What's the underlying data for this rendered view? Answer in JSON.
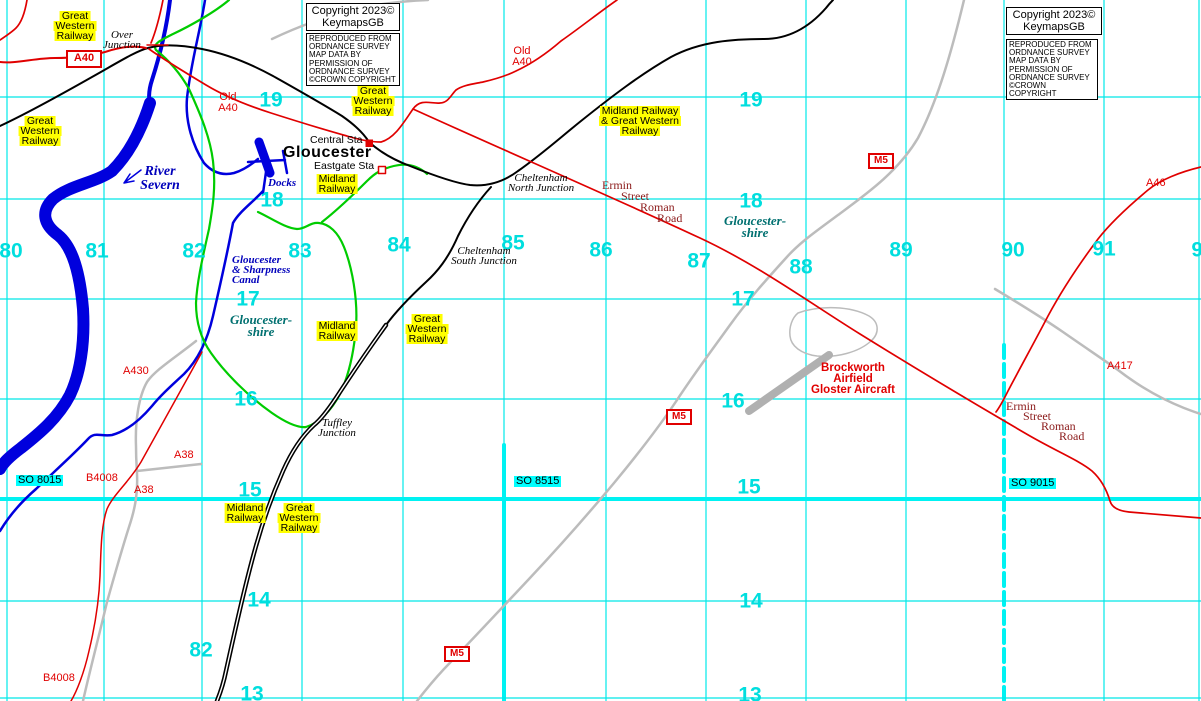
{
  "colors": {
    "grid": "#00e8e8",
    "gridbold": "#00f2f2",
    "num": "#00dede",
    "water": "#0000dd",
    "watertext": "#0000bb",
    "rail": "#000000",
    "roadred": "#e00000",
    "roadgray": "#bcbcbc",
    "runway": "#b0b0b0",
    "boundary": "#00cc00",
    "county": "#007070",
    "roman": "#8b1a1a",
    "highlight": "#ffff00",
    "sqbg": "#00ffff"
  },
  "grid": {
    "vlines": [
      {
        "x": 7
      },
      {
        "x": 104
      },
      {
        "x": 202
      },
      {
        "x": 302
      },
      {
        "x": 403
      },
      {
        "x": 504,
        "thickFrom": 445
      },
      {
        "x": 606
      },
      {
        "x": 706
      },
      {
        "x": 806
      },
      {
        "x": 906
      },
      {
        "x": 1004,
        "thickFrom": 345,
        "dash": true
      },
      {
        "x": 1104
      },
      {
        "x": 1199
      }
    ],
    "hlines": [
      {
        "y": 97
      },
      {
        "y": 199
      },
      {
        "y": 299
      },
      {
        "y": 399
      },
      {
        "y": 499,
        "thick": true
      },
      {
        "y": 601
      },
      {
        "y": 698
      }
    ],
    "numbers": [
      {
        "t": "80",
        "x": 11,
        "y": 251
      },
      {
        "t": "81",
        "x": 97,
        "y": 251
      },
      {
        "t": "82",
        "x": 194,
        "y": 251
      },
      {
        "t": "83",
        "x": 300,
        "y": 251
      },
      {
        "t": "84",
        "x": 399,
        "y": 245
      },
      {
        "t": "85",
        "x": 513,
        "y": 243
      },
      {
        "t": "86",
        "x": 601,
        "y": 250
      },
      {
        "t": "87",
        "x": 699,
        "y": 261
      },
      {
        "t": "88",
        "x": 801,
        "y": 267
      },
      {
        "t": "89",
        "x": 901,
        "y": 250
      },
      {
        "t": "90",
        "x": 1013,
        "y": 250
      },
      {
        "t": "91",
        "x": 1104,
        "y": 249
      },
      {
        "t": "92",
        "x": 1203,
        "y": 250
      },
      {
        "t": "82",
        "x": 201,
        "y": 650
      },
      {
        "t": "19",
        "x": 271,
        "y": 100
      },
      {
        "t": "19",
        "x": 751,
        "y": 100
      },
      {
        "t": "18",
        "x": 272,
        "y": 200
      },
      {
        "t": "18",
        "x": 751,
        "y": 201
      },
      {
        "t": "17",
        "x": 248,
        "y": 299
      },
      {
        "t": "17",
        "x": 743,
        "y": 299
      },
      {
        "t": "16",
        "x": 246,
        "y": 399
      },
      {
        "t": "16",
        "x": 733,
        "y": 401
      },
      {
        "t": "15",
        "x": 250,
        "y": 490
      },
      {
        "t": "15",
        "x": 749,
        "y": 487
      },
      {
        "t": "14",
        "x": 259,
        "y": 600
      },
      {
        "t": "14",
        "x": 751,
        "y": 601
      },
      {
        "t": "13",
        "x": 252,
        "y": 694
      },
      {
        "t": "13",
        "x": 750,
        "y": 695
      }
    ]
  },
  "boxes": [
    {
      "name": "copyright-box-left",
      "cls": "cpr",
      "x": 306,
      "y": 3,
      "w": 88,
      "lines": [
        "Copyright 2023©",
        "KeymapsGB"
      ]
    },
    {
      "name": "os-credit-box-left",
      "cls": "os",
      "x": 306,
      "y": 33,
      "w": 88,
      "lines": [
        "REPRODUCED FROM",
        "ORDNANCE SURVEY",
        "MAP DATA BY",
        "PERMISSION OF",
        "ORDNANCE SURVEY",
        "©CROWN COPYRIGHT"
      ]
    },
    {
      "name": "copyright-box-right",
      "cls": "cpr",
      "x": 1006,
      "y": 7,
      "w": 90,
      "lines": [
        "Copyright 2023©",
        "KeymapsGB"
      ]
    },
    {
      "name": "os-credit-box-right",
      "cls": "os",
      "x": 1006,
      "y": 39,
      "w": 86,
      "lines": [
        "REPRODUCED FROM",
        "ORDNANCE SURVEY",
        "MAP DATA BY",
        "PERMISSION OF",
        "ORDNANCE SURVEY",
        "©CROWN COPYRIGHT"
      ]
    }
  ],
  "shields": [
    {
      "t": "A40",
      "x": 66,
      "y": 50,
      "w": 32,
      "h": 14,
      "big": true
    },
    {
      "t": "M5",
      "x": 868,
      "y": 153,
      "w": 22,
      "h": 12
    },
    {
      "t": "M5",
      "x": 666,
      "y": 409,
      "w": 22,
      "h": 12
    },
    {
      "t": "M5",
      "x": 444,
      "y": 646,
      "w": 22,
      "h": 12
    }
  ],
  "labels": [
    {
      "name": "label-gwr-topleft",
      "cls": "rail",
      "x": 75,
      "y": 11,
      "align": "c",
      "lines": [
        "Great",
        "Western",
        "Railway"
      ]
    },
    {
      "name": "label-gwr-left",
      "cls": "rail",
      "x": 40,
      "y": 116,
      "align": "c",
      "lines": [
        "Great",
        "Western",
        "Railway"
      ]
    },
    {
      "name": "label-gwr-topcenter",
      "cls": "rail",
      "x": 373,
      "y": 86,
      "align": "c",
      "lines": [
        "Great",
        "Western",
        "Railway"
      ]
    },
    {
      "name": "label-midland-eastgate",
      "cls": "rail",
      "x": 337,
      "y": 174,
      "align": "c",
      "lines": [
        "Midland",
        "Railway"
      ]
    },
    {
      "name": "label-midland-center",
      "cls": "rail",
      "x": 337,
      "y": 321,
      "align": "c",
      "lines": [
        "Midland",
        "Railway"
      ]
    },
    {
      "name": "label-gwr-center",
      "cls": "rail",
      "x": 427,
      "y": 314,
      "align": "c",
      "lines": [
        "Great",
        "Western",
        "Railway"
      ]
    },
    {
      "name": "label-midland-bottom",
      "cls": "rail",
      "x": 245,
      "y": 503,
      "align": "c",
      "lines": [
        "Midland",
        "Railway"
      ]
    },
    {
      "name": "label-gwr-bottom",
      "cls": "rail",
      "x": 299,
      "y": 503,
      "align": "c",
      "lines": [
        "Great",
        "Western",
        "Railway"
      ]
    },
    {
      "name": "label-midland-and-gwr",
      "cls": "rail",
      "x": 640,
      "y": 106,
      "align": "c",
      "lines": [
        "Midland Railway",
        "& Great Western",
        "Railway"
      ]
    },
    {
      "name": "label-old-a40-west",
      "cls": "road",
      "x": 228,
      "y": 92,
      "align": "c",
      "lines": [
        "Old",
        "A40"
      ]
    },
    {
      "name": "label-old-a40-east",
      "cls": "road",
      "x": 522,
      "y": 46,
      "align": "c",
      "lines": [
        "Old",
        "A40"
      ]
    },
    {
      "name": "label-a46",
      "cls": "road",
      "x": 1146,
      "y": 178,
      "lines": [
        "A46"
      ]
    },
    {
      "name": "label-a417",
      "cls": "road",
      "x": 1107,
      "y": 361,
      "lines": [
        "A417"
      ]
    },
    {
      "name": "label-a430",
      "cls": "road",
      "x": 123,
      "y": 366,
      "lines": [
        "A430"
      ]
    },
    {
      "name": "label-a38-upper",
      "cls": "road",
      "x": 174,
      "y": 450,
      "lines": [
        "A38"
      ]
    },
    {
      "name": "label-a38-lower",
      "cls": "road",
      "x": 134,
      "y": 485,
      "lines": [
        "A38"
      ]
    },
    {
      "name": "label-b4008-upper",
      "cls": "road",
      "x": 86,
      "y": 473,
      "lines": [
        "B4008"
      ]
    },
    {
      "name": "label-b4008-lower",
      "cls": "road",
      "x": 43,
      "y": 673,
      "lines": [
        "B4008"
      ]
    },
    {
      "name": "label-ermin-1a",
      "cls": "roman",
      "x": 602,
      "y": 180,
      "lines": [
        "Ermin"
      ]
    },
    {
      "name": "label-ermin-1b",
      "cls": "roman",
      "x": 621,
      "y": 191,
      "lines": [
        "Street"
      ]
    },
    {
      "name": "label-ermin-1c",
      "cls": "roman",
      "x": 640,
      "y": 202,
      "lines": [
        "Roman"
      ]
    },
    {
      "name": "label-ermin-1d",
      "cls": "roman",
      "x": 657,
      "y": 213,
      "lines": [
        "Road"
      ]
    },
    {
      "name": "label-ermin-2a",
      "cls": "roman",
      "x": 1006,
      "y": 401,
      "lines": [
        "Ermin"
      ]
    },
    {
      "name": "label-ermin-2b",
      "cls": "roman",
      "x": 1023,
      "y": 411,
      "lines": [
        "Street"
      ]
    },
    {
      "name": "label-ermin-2c",
      "cls": "roman",
      "x": 1041,
      "y": 421,
      "lines": [
        "Roman"
      ]
    },
    {
      "name": "label-ermin-2d",
      "cls": "roman",
      "x": 1059,
      "y": 431,
      "lines": [
        "Road"
      ]
    },
    {
      "name": "label-over-junction",
      "cls": "jct",
      "x": 122,
      "y": 30,
      "align": "c",
      "lines": [
        "Over",
        "Junction"
      ]
    },
    {
      "name": "label-cheltenham-north-junction",
      "cls": "jct",
      "x": 541,
      "y": 173,
      "align": "c",
      "lines": [
        "Cheltenham",
        "North Junction"
      ]
    },
    {
      "name": "label-cheltenham-south-junction",
      "cls": "jct",
      "x": 484,
      "y": 246,
      "align": "c",
      "lines": [
        "Cheltenham",
        "South Junction"
      ]
    },
    {
      "name": "label-tuffley-junction",
      "cls": "jct",
      "x": 337,
      "y": 418,
      "align": "c",
      "lines": [
        "Tuffley",
        "Junction"
      ]
    },
    {
      "name": "label-central-station",
      "cls": "sta",
      "x": 310,
      "y": 135,
      "lines": [
        "Central Sta"
      ]
    },
    {
      "name": "label-eastgate-station",
      "cls": "sta",
      "x": 314,
      "y": 161,
      "lines": [
        "Eastgate Sta"
      ]
    },
    {
      "name": "label-gloucester-city",
      "cls": "city",
      "x": 283,
      "y": 145,
      "lines": [
        "Gloucester"
      ]
    },
    {
      "name": "label-river-severn",
      "cls": "water lg",
      "x": 160,
      "y": 165,
      "align": "c",
      "lines": [
        "River",
        "Severn"
      ]
    },
    {
      "name": "label-docks",
      "cls": "water",
      "x": 268,
      "y": 178,
      "lines": [
        "Docks"
      ]
    },
    {
      "name": "label-canal",
      "cls": "water",
      "x": 232,
      "y": 255,
      "lines": [
        "Gloucester",
        "& Sharpness",
        "Canal"
      ]
    },
    {
      "name": "label-gloucestershire-west",
      "cls": "county",
      "x": 261,
      "y": 314,
      "align": "c",
      "lines": [
        "Gloucester-",
        "shire"
      ]
    },
    {
      "name": "label-gloucestershire-east",
      "cls": "county",
      "x": 755,
      "y": 215,
      "align": "c",
      "lines": [
        "Gloucester-",
        "shire"
      ]
    },
    {
      "name": "label-so8015",
      "cls": "sq",
      "x": 16,
      "y": 475,
      "lines": [
        "SO 8015"
      ]
    },
    {
      "name": "label-so8515",
      "cls": "sq",
      "x": 514,
      "y": 476,
      "lines": [
        "SO 8515"
      ]
    },
    {
      "name": "label-so9015",
      "cls": "sq",
      "x": 1009,
      "y": 478,
      "lines": [
        "SO 9015"
      ]
    },
    {
      "name": "label-brockworth-airfield",
      "cls": "air",
      "x": 853,
      "y": 363,
      "align": "c",
      "lines": [
        "Brockworth",
        "Airfield",
        "Gloster Aircraft"
      ]
    }
  ]
}
